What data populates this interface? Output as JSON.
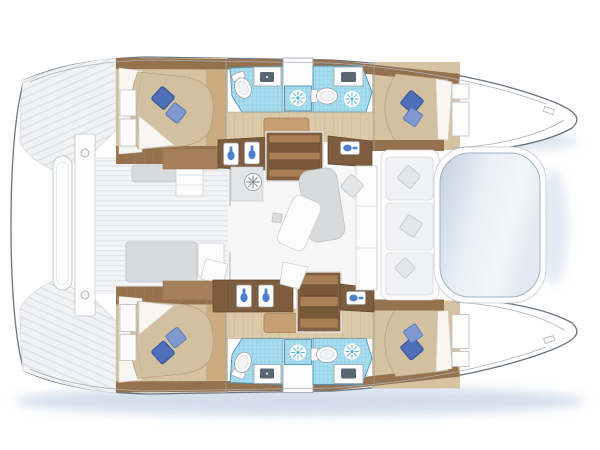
{
  "meta": {
    "description": "Catamaran yacht floor plan, top-down view, bow to the right, four cabins and four heads",
    "visible_text": "none"
  },
  "palette": {
    "hullWhite": "#ffffff",
    "outline": "#6b747e",
    "outlineSoft": "#a8b0b8",
    "woodDark": "#7e5d3e",
    "woodMid": "#96714e",
    "woodLight": "#a5805b",
    "stepLight": "#a87e55",
    "stepDark": "#7a5939",
    "floorBeige": "#d5c3a2",
    "corridorBeige": "#dbc9a8",
    "dresserTan": "#c59e72",
    "bedBeige": "#d2c0a0",
    "sheetWhite": "#f7f6f2",
    "pillowBlue": "#4f6fb8",
    "pillowLight": "#7f98cf",
    "pillowDark": "#31519b",
    "tileBlue": "#a8dcee",
    "tileGrid": "#7fcbe3",
    "tileEdge": "#4e93b8",
    "sunRay": "#5fb5d4",
    "faucetBlue": "#4d7fd0",
    "basinDark": "#5a6672",
    "fixtureLine": "#9aa2ab",
    "furnGray": "#d8dadc",
    "shadowBlue": "#9fb8d6",
    "trampolineEdge": "#9fb2c6"
  },
  "inventory": {
    "hulls": [
      {
        "side": "port (top)",
        "rooms": [
          "aft double cabin with two blue pillows",
          "aft head: toilet, sink vanity, tiled shower with shower symbol",
          "forward head: toilet, sink vanity, tiled shower with shower symbol",
          "corridor with dresser",
          "forward double cabin with two blue pillows"
        ]
      },
      {
        "side": "starboard (bottom)",
        "rooms": [
          "aft double cabin with two blue pillows",
          "aft head: toilet, sink vanity, tiled shower with shower symbol",
          "forward head: toilet, sink vanity, tiled shower with shower symbol",
          "corridor with dresser",
          "forward double cabin with two blue pillows"
        ]
      }
    ],
    "bridge_deck": {
      "salon": [
        "wheel / fan symbol",
        "dining table",
        "tilted bench",
        "forward settee with cushion",
        "galley counter with double sink (port side)",
        "counter with double sink (starboard side)",
        "forward sink counters port and starboard",
        "companionway steps to each hull"
      ],
      "cockpit": [
        "aft bench",
        "storage module",
        "sunpad",
        "cockpit table",
        "stool"
      ],
      "foredeck": [
        "forward bench with three cushions and three pillows",
        "trampoline"
      ]
    },
    "stern": [
      "port transom platform",
      "starboard transom platform",
      "central walkway with mooring cleats",
      "tender / dinghy outline"
    ]
  }
}
